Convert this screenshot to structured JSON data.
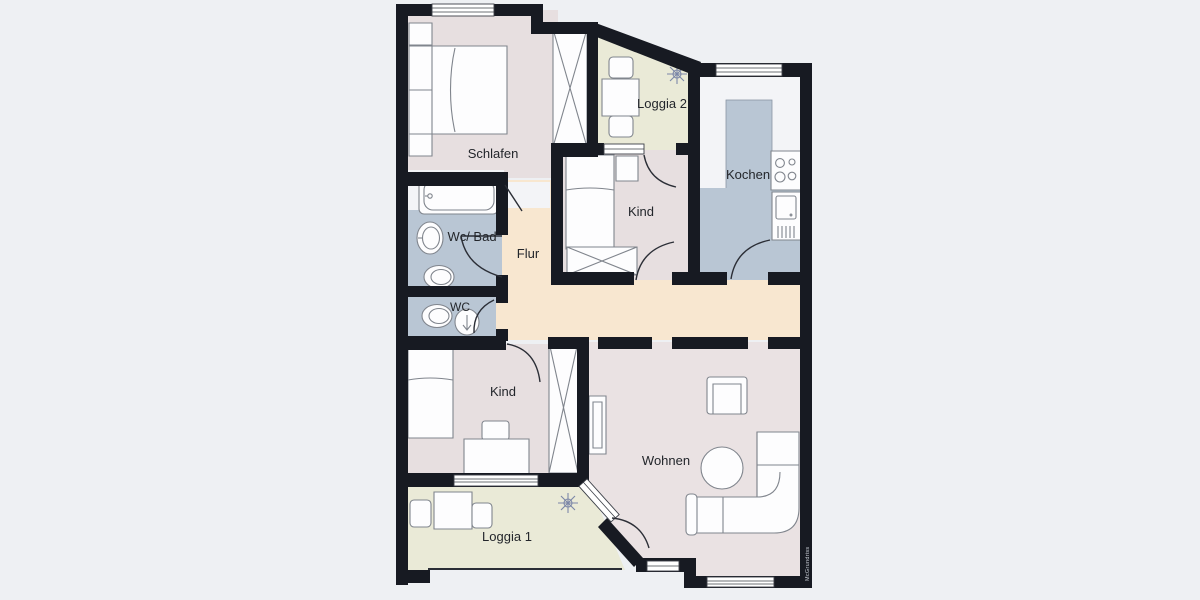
{
  "plan": {
    "rooms": {
      "schlafen": {
        "label": "Schlafen"
      },
      "loggia2": {
        "label": "Loggia 2"
      },
      "kochen": {
        "label": "Kochen"
      },
      "kind_top": {
        "label": "Kind"
      },
      "wc_bad": {
        "label": "Wc/ Bad"
      },
      "flur": {
        "label": "Flur"
      },
      "wc": {
        "label": "WC"
      },
      "kind_bottom": {
        "label": "Kind"
      },
      "wohnen": {
        "label": "Wohnen"
      },
      "loggia1": {
        "label": "Loggia 1"
      }
    },
    "watermark": "McGrundriss",
    "colors": {
      "background": "#eef0f3",
      "wall": "#171a22",
      "floor_pink": "#e7dfe0",
      "floor_pink2": "#eae2e3",
      "floor_peach": "#f8e7d0",
      "floor_green": "#eaead7",
      "floor_blue": "#b9c6d4",
      "floor_white": "#f3f4f7",
      "furniture": "#fdfdfe",
      "label": "#23262b"
    }
  }
}
